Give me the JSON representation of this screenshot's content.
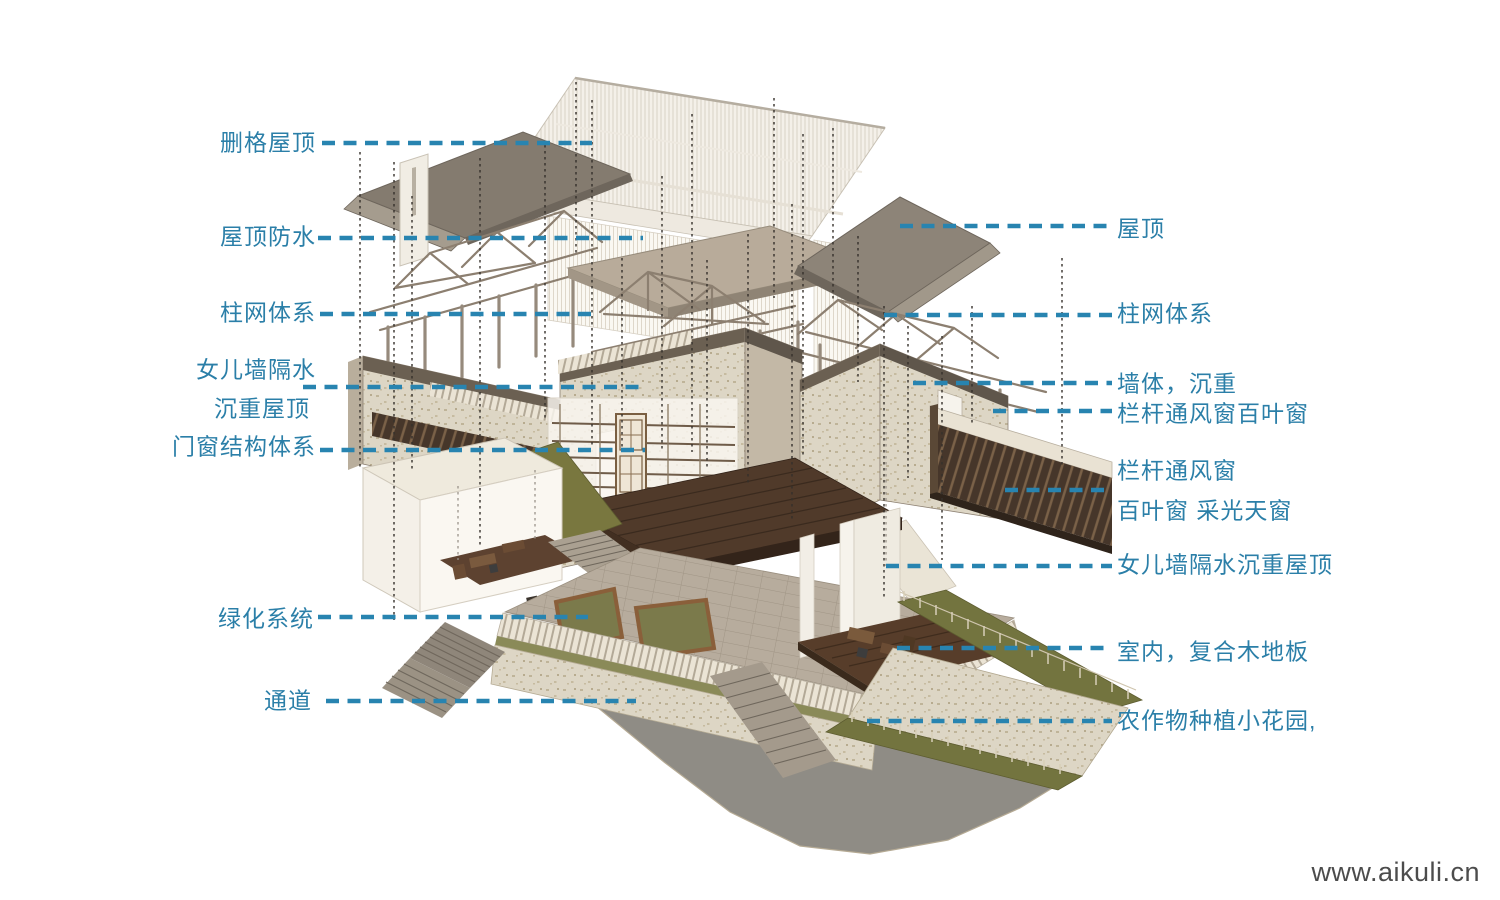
{
  "meta": {
    "watermark": "www.aikuli.cn"
  },
  "colors": {
    "annotation_text": "#2b7fa8",
    "leader_dash": "#2884b0",
    "guide_dash": "#35302b",
    "roof": "#8d8478",
    "masonry": "#ddd6c5",
    "dark_wood": "#503a2a",
    "greenery": "#73743f",
    "road": "#8f8c85"
  },
  "annotations": {
    "left": [
      {
        "text": "删格屋顶",
        "y": 143,
        "text_x": 316,
        "line": {
          "x1": 322,
          "x2": 592,
          "y": 143
        }
      },
      {
        "text": "屋顶防水",
        "y": 237,
        "text_x": 316,
        "line": {
          "x1": 318,
          "x2": 643,
          "y": 238
        }
      },
      {
        "text": "柱网体系",
        "y": 313,
        "text_x": 316,
        "line": {
          "x1": 320,
          "x2": 596,
          "y": 314
        }
      },
      {
        "text": "女儿墙隔水",
        "y": 370,
        "text_x": 316,
        "line": {
          "x1": 303,
          "x2": 640,
          "y": 387
        }
      },
      {
        "text": "沉重屋顶",
        "y": 409,
        "text_x": 310
      },
      {
        "text": "门窗结构体系",
        "y": 447,
        "text_x": 316,
        "line": {
          "x1": 320,
          "x2": 645,
          "y": 450
        }
      },
      {
        "text": "绿化系统",
        "y": 619,
        "text_x": 314,
        "line": {
          "x1": 318,
          "x2": 588,
          "y": 617
        }
      },
      {
        "text": "通道",
        "y": 701,
        "text_x": 312,
        "line": {
          "x1": 326,
          "x2": 636,
          "y": 701
        }
      }
    ],
    "right": [
      {
        "text": "屋顶",
        "y": 229,
        "text_x": 1117,
        "line": {
          "x1": 900,
          "x2": 1112,
          "y": 226
        }
      },
      {
        "text": "柱网体系",
        "y": 314,
        "text_x": 1117,
        "line": {
          "x1": 884,
          "x2": 1112,
          "y": 315
        }
      },
      {
        "text": "墙体，沉重",
        "y": 384,
        "text_x": 1117,
        "line": {
          "x1": 913,
          "x2": 1112,
          "y": 383
        }
      },
      {
        "text": "栏杆通风窗百叶窗",
        "y": 414,
        "text_x": 1117,
        "line": {
          "x1": 993,
          "x2": 1112,
          "y": 411
        }
      },
      {
        "text": "栏杆通风窗",
        "y": 471,
        "text_x": 1117,
        "line": {
          "x1": 1005,
          "x2": 1112,
          "y": 490
        }
      },
      {
        "text": "百叶窗 采光天窗",
        "y": 511,
        "text_x": 1117
      },
      {
        "text": "女儿墙隔水沉重屋顶",
        "y": 565,
        "text_x": 1117,
        "line": {
          "x1": 886,
          "x2": 1112,
          "y": 566
        }
      },
      {
        "text": "室内，复合木地板",
        "y": 652,
        "text_x": 1117,
        "line": {
          "x1": 897,
          "x2": 1112,
          "y": 648
        }
      },
      {
        "text": "农作物种植小花园,",
        "y": 721,
        "text_x": 1117,
        "line": {
          "x1": 867,
          "x2": 1112,
          "y": 721
        }
      }
    ]
  }
}
